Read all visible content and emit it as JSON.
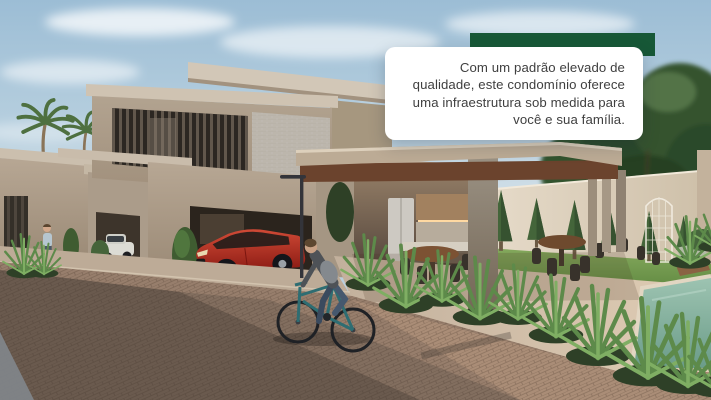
{
  "overlay_card": {
    "lines": [
      "Com um padrão elevado de",
      "qualidade, este condomínio oferece",
      "uma infraestrutura sob medida para",
      "você e sua família."
    ]
  },
  "palette": {
    "accent_green": "#175837",
    "card_white": "#ffffff",
    "card_text": "#3f3f3f",
    "sky_blue": "#a7c4d8",
    "wall_beige": "#b2a391",
    "roof_taupe": "#cfc4b4",
    "road_brick": "#977e6c",
    "road_shadow": "#3d3530",
    "pavement_light": "#d0bda8",
    "lawn_green": "#6f9c53",
    "foliage_green": "#33522f",
    "pool_teal": "#84b0a0",
    "red_car": "#b5281f"
  },
  "scene": {
    "type": "3d-architectural-render",
    "objects": [
      "sky",
      "clouds",
      "tree-line",
      "palm-trees",
      "house-left",
      "house-main",
      "carport",
      "red-suv",
      "white-car",
      "pedestrian",
      "dog",
      "street-lamp",
      "clubhouse-pavilion",
      "outdoor-kitchen",
      "dining-tables",
      "white-privacy-wall",
      "lawn",
      "cypress-trees",
      "trellis",
      "sun-lounger",
      "swimming-pool",
      "paver-road",
      "sidewalk",
      "agave-plants",
      "cyclist"
    ]
  }
}
